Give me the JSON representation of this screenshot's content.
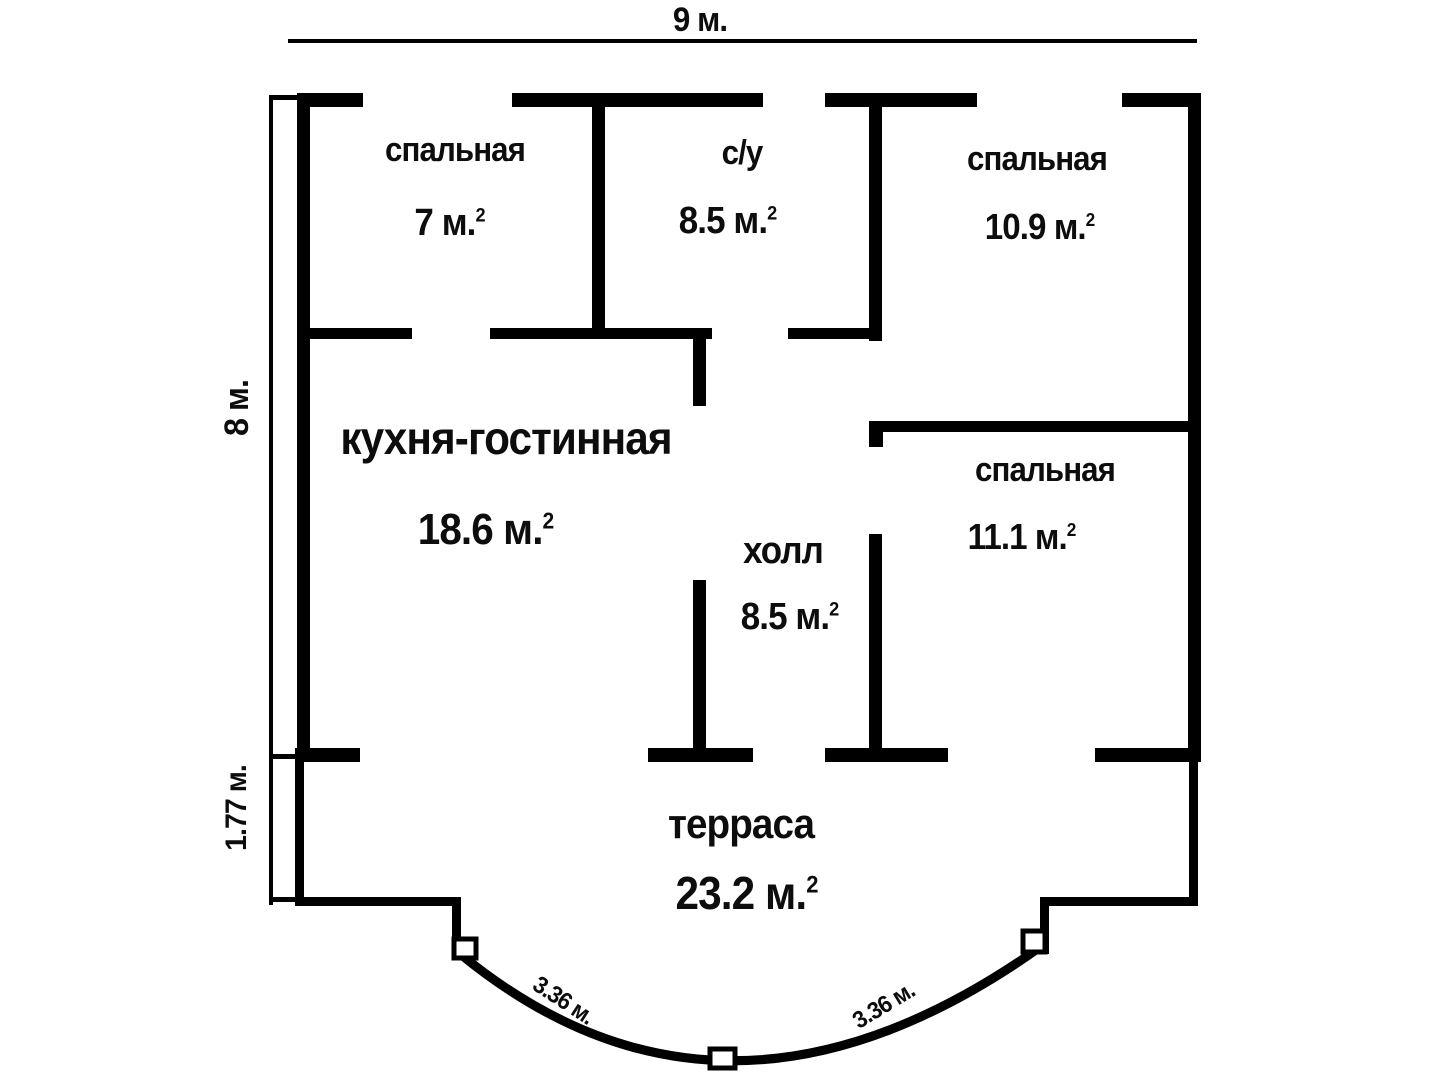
{
  "plan": {
    "type": "floor-plan",
    "rooms": [
      {
        "name": "спальная",
        "area": "7 м.",
        "sup": "2"
      },
      {
        "name": "с/у",
        "area": "8.5 м.",
        "sup": "2"
      },
      {
        "name": "спальная",
        "area": "10.9 м.",
        "sup": "2"
      },
      {
        "name": "кухня-гостинная",
        "area": "18.6 м.",
        "sup": "2"
      },
      {
        "name": "холл",
        "area": "8.5 м.",
        "sup": "2"
      },
      {
        "name": "спальная",
        "area": "11.1 м.",
        "sup": "2"
      },
      {
        "name": "терраса",
        "area": "23.2 м.",
        "sup": "2"
      }
    ],
    "dimensions": {
      "width_top": "9 м.",
      "height_main": "8 м.",
      "height_terrace": "1.77 м.",
      "arc_left": "3.36 м.",
      "arc_right": "3.36 м."
    },
    "colors": {
      "wall": "#000000",
      "background": "#ffffff",
      "text": "#0d0d0d"
    }
  }
}
